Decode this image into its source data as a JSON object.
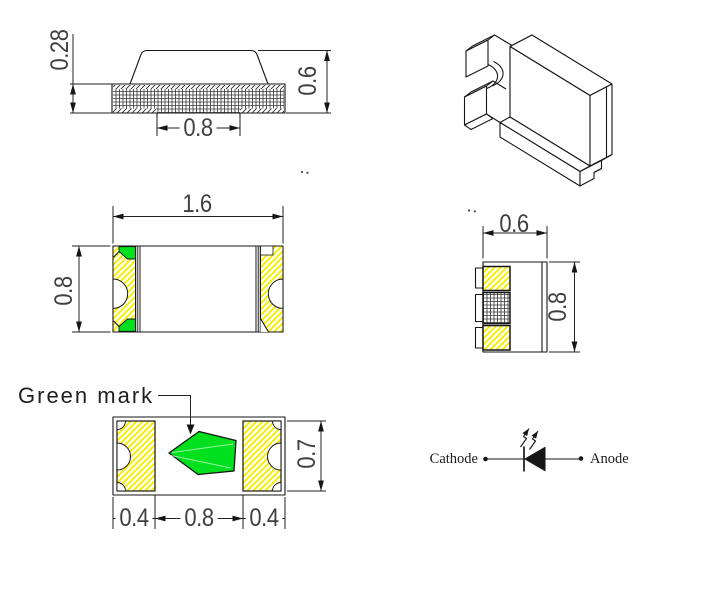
{
  "side_view": {
    "substrate_thickness": "0.28",
    "total_height": "0.6",
    "bottom_pad_gap": "0.8"
  },
  "top_view": {
    "package_length": "1.6",
    "package_width": "0.8"
  },
  "end_view": {
    "package_depth": "0.6",
    "package_height": "0.8"
  },
  "bottom_view": {
    "green_mark_label": "Green mark",
    "left_pad_length": "0.4",
    "pad_gap": "0.8",
    "right_pad_length": "0.4",
    "pad_width": "0.7"
  },
  "polarity_symbol": {
    "cathode_label": "Cathode",
    "anode_label": "Anode"
  },
  "colors": {
    "green_mark": "#00e01e",
    "hatch_yellow": "#f9ee00",
    "line": "#161616",
    "dim_text": "#3f3f3f"
  }
}
